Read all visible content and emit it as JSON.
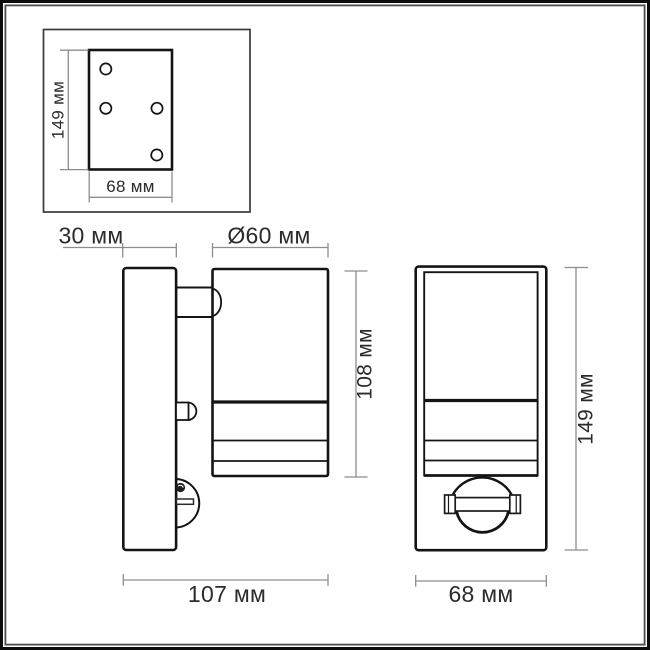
{
  "units": "мм",
  "colors": {
    "background": "#ffffff",
    "object_line": "#141414",
    "dimension_line": "#8d8d8d",
    "label_text": "#2b2b2b",
    "frame_outer": "#0d0d0d",
    "frame_inner": "#4c4c4c"
  },
  "mounting_plate_view": {
    "height_label": "149 мм",
    "width_label": "68 мм",
    "holes": 4
  },
  "side_view": {
    "plate_depth_label": "30 мм",
    "head_diameter_label": "Ø60 мм",
    "head_height_label": "108 мм",
    "total_depth_label": "107 мм"
  },
  "front_view": {
    "height_label": "149 мм",
    "width_label": "68 мм"
  }
}
